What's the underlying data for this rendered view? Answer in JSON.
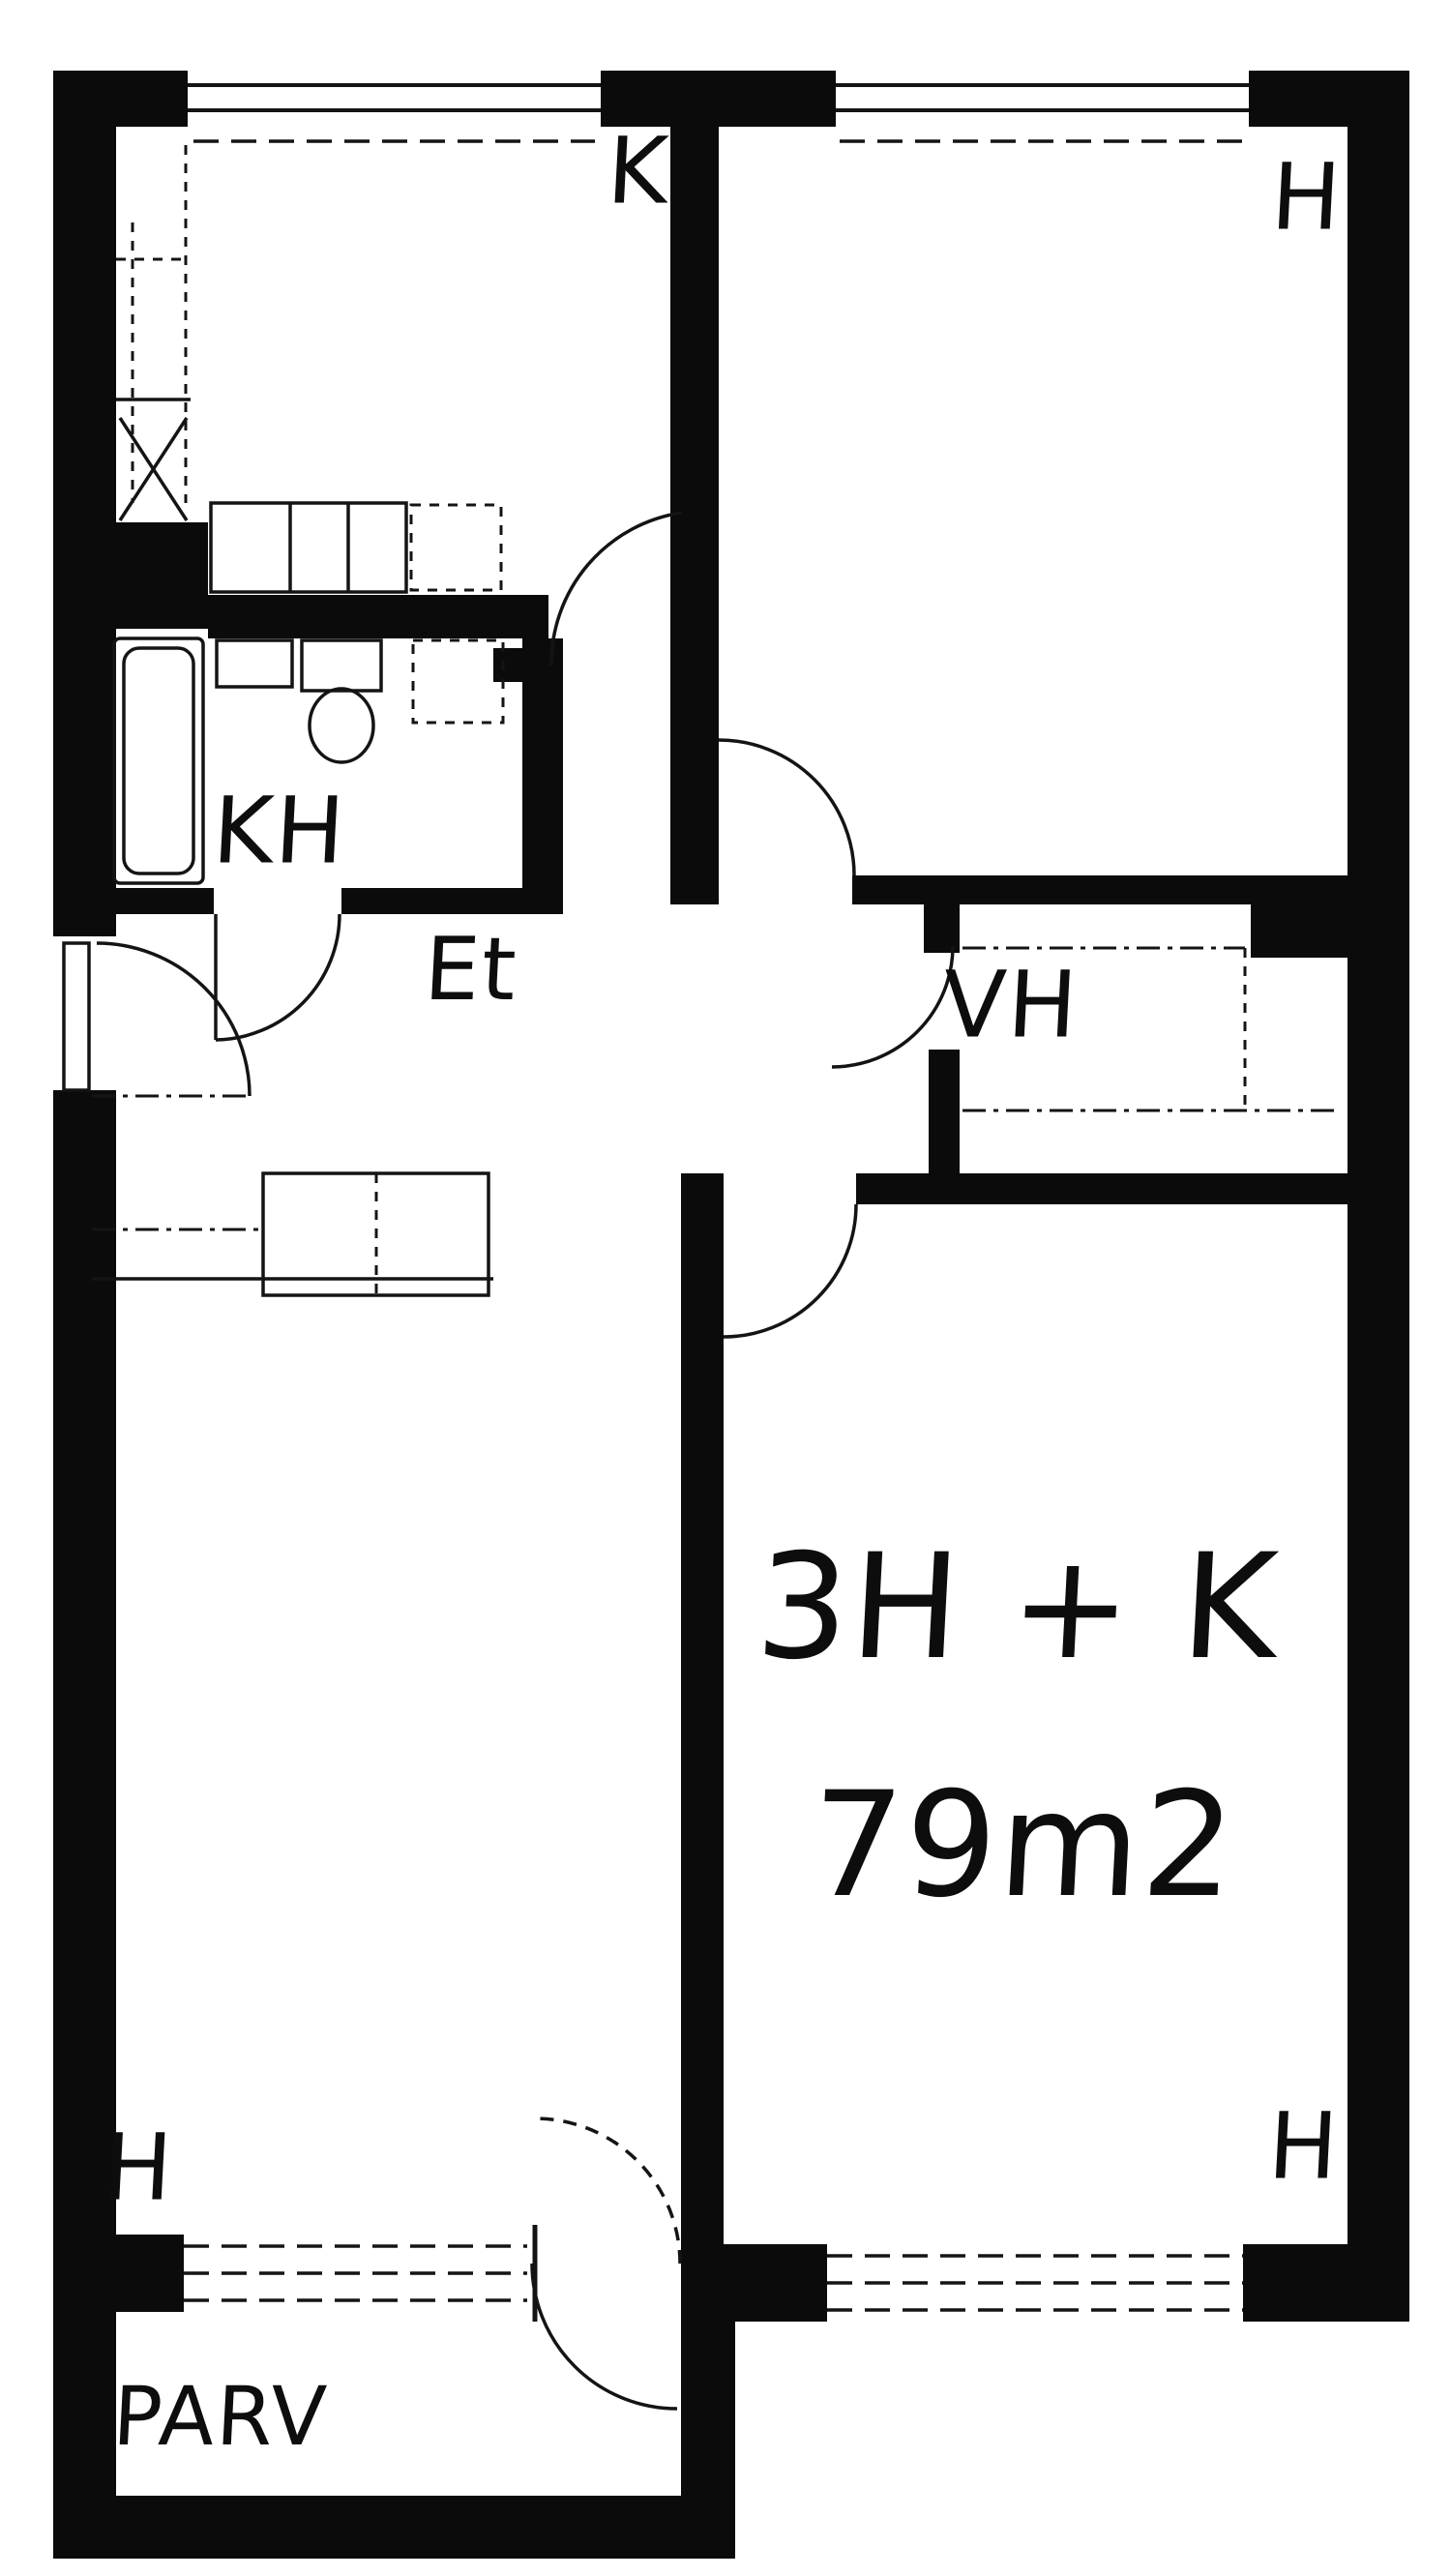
{
  "drawing": {
    "type": "apartment floor plan",
    "ink_color": "#0d0d0d",
    "paper_color": "#ffffff",
    "apartment_type": "3H + K",
    "area": "79m2",
    "rooms": [
      {
        "id": "kitchen",
        "label": "K",
        "meaning": "keittiö / kitchen"
      },
      {
        "id": "room-top-right",
        "label": "H",
        "meaning": "huone / room"
      },
      {
        "id": "bathroom",
        "label": "KH",
        "meaning": "kylpyhuone / bathroom"
      },
      {
        "id": "entry-hall",
        "label": "Et",
        "meaning": "eteinen / entry hall"
      },
      {
        "id": "closet",
        "label": "VH",
        "meaning": "vaatehuone / walk-in closet"
      },
      {
        "id": "room-bottom-left",
        "label": "H",
        "meaning": "huone / room"
      },
      {
        "id": "room-bottom-right",
        "label": "H",
        "meaning": "huone / room"
      },
      {
        "id": "balcony",
        "label": "PARV",
        "meaning": "parveke / balcony"
      }
    ]
  }
}
